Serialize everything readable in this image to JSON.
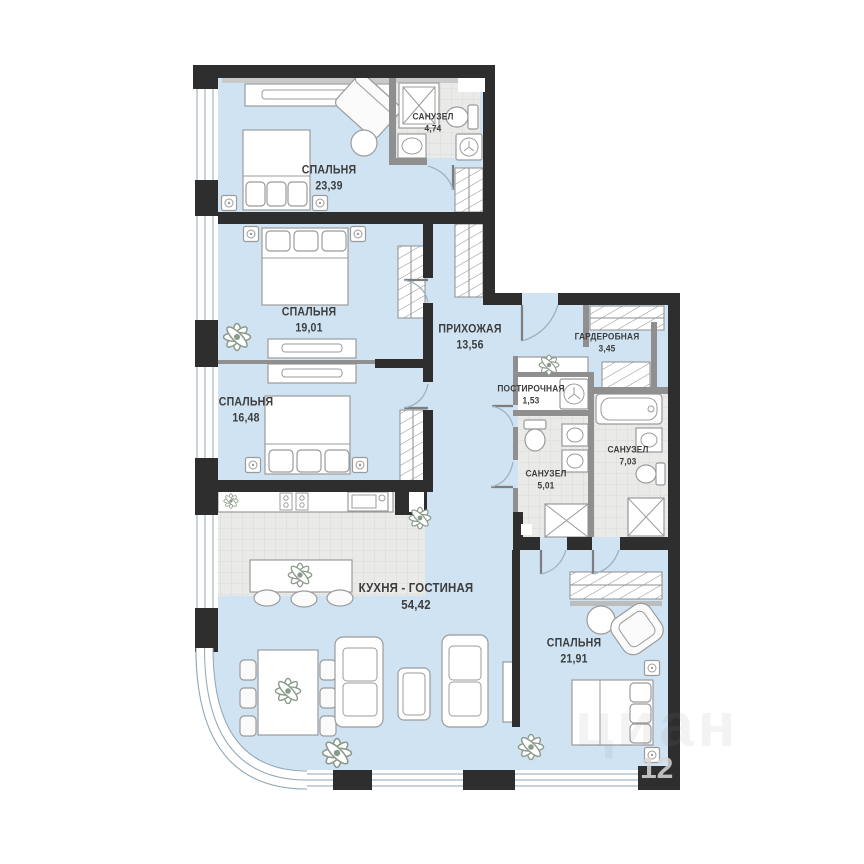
{
  "plan_title": "Apartment floor plan",
  "rooms": [
    {
      "id": "bedroom-1",
      "label": "СПАЛЬНЯ",
      "area": "23,39"
    },
    {
      "id": "bathroom-1",
      "label": "САНУЗЕЛ",
      "area": "4,74"
    },
    {
      "id": "bedroom-2",
      "label": "СПАЛЬНЯ",
      "area": "19,01"
    },
    {
      "id": "bedroom-3",
      "label": "СПАЛЬНЯ",
      "area": "16,48"
    },
    {
      "id": "hallway",
      "label": "ПРИХОЖАЯ",
      "area": "13,56"
    },
    {
      "id": "wardrobe-room",
      "label": "ГАРДЕРОБНАЯ",
      "area": "3,45"
    },
    {
      "id": "laundry",
      "label": "ПОСТИРОЧНАЯ",
      "area": "1,53"
    },
    {
      "id": "bathroom-2",
      "label": "САНУЗЕЛ",
      "area": "5,01"
    },
    {
      "id": "bathroom-3",
      "label": "САНУЗЕЛ",
      "area": "7,03"
    },
    {
      "id": "kitchen-living",
      "label": "КУХНЯ - ГОСТИНАЯ",
      "area": "54,42"
    },
    {
      "id": "bedroom-4",
      "label": "СПАЛЬНЯ",
      "area": "21,91"
    }
  ],
  "watermark": {
    "logo": "циан",
    "number": "12"
  },
  "colors": {
    "floor": "#cfe3f2",
    "tile": "#eaeae8",
    "wall": "#2e2e2e",
    "partition": "#8f8f8f",
    "window_frame": "#8fa6b5",
    "furniture_stroke": "#9b9b9b",
    "label": "#3d3d3d"
  }
}
